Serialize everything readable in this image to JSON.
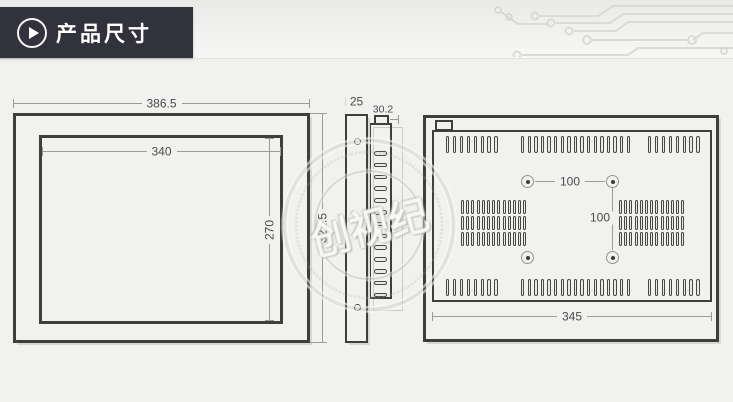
{
  "header": {
    "title": "产品尺寸",
    "icon": "play-arrow-circle-icon"
  },
  "watermark": {
    "text": "创视纪"
  },
  "front_view": {
    "dims": {
      "overall_width": "386.5",
      "screen_width": "340",
      "screen_height": "270",
      "overall_height": "321.5"
    }
  },
  "side_view": {
    "dims": {
      "front_thickness": "25",
      "rear_depth": "30.2"
    }
  },
  "back_view": {
    "dims": {
      "vesa_horizontal": "100",
      "vesa_vertical": "100",
      "mount_width": "345"
    }
  },
  "colors": {
    "title_block_bg": "#31323b",
    "drawing_line": "#3e3e3c",
    "dimension_line": "#9a9a98",
    "page_bg": "#f1f1ef"
  },
  "generated": {
    "back_top_vents": {
      "y": 136,
      "slot_w": 3.4,
      "slot_h": 17,
      "groups": [
        {
          "x": 446,
          "count": 8,
          "gap": 6.9
        },
        {
          "x": 521,
          "count": 17,
          "gap": 6.6
        },
        {
          "x": 648,
          "count": 8,
          "gap": 6.9
        }
      ]
    },
    "back_bottom_vents": {
      "y": 279,
      "slot_w": 3.4,
      "slot_h": 17,
      "groups": [
        {
          "x": 446,
          "count": 8,
          "gap": 6.9
        },
        {
          "x": 521,
          "count": 17,
          "gap": 6.6
        },
        {
          "x": 648,
          "count": 8,
          "gap": 6.9
        }
      ]
    },
    "back_side_blocks": {
      "rows_y": [
        200,
        216,
        232
      ],
      "slot_w": 3,
      "slot_h": 14,
      "cols": 13,
      "gap": 5.2,
      "block_x": [
        461,
        619
      ]
    },
    "side_view_slots": {
      "x": 373.5,
      "w": 13,
      "h": 4.6,
      "start_y": 151,
      "step": 11.8,
      "count": 13
    }
  }
}
